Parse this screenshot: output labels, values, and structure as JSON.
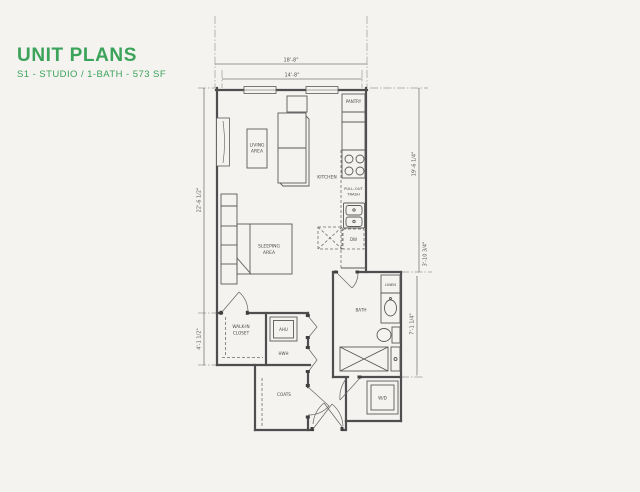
{
  "colors": {
    "accent": "#3ba35a",
    "paper": "#f4f3f0",
    "line": "#4e4e4e",
    "dim": "#777777"
  },
  "header": {
    "title": "UNIT PLANS",
    "subtitle": "S1 - STUDIO / 1-BATH - 573 SF"
  },
  "plan": {
    "labels": {
      "living_line1": "LIVING",
      "living_line2": "AREA",
      "kitchen": "KITCHEN",
      "pantry": "PANTRY",
      "trash_line1": "PULL-OUT",
      "trash_line2": "TRASH",
      "dishwasher": "DW",
      "sleeping_line1": "SLEEPING",
      "sleeping_line2": "AREA",
      "closet_line1": "WALK-IN",
      "closet_line2": "CLOSET",
      "ahu": "AHU",
      "hwh": "HWH",
      "coats": "COATS",
      "bath": "BATH",
      "linen": "LINEN",
      "washer_dryer": "W/D"
    },
    "dimensions": {
      "top_outer": "18'-8\"",
      "top_inner": "14'-8\"",
      "left_upper": "22'-6 1/2\"",
      "left_lower": "4'-1 1/2\"",
      "right_upper": "19'-6 1/4\"",
      "right_step": "3'-10 3/4\"",
      "bath_wall": "7'-1 1/4\""
    }
  }
}
